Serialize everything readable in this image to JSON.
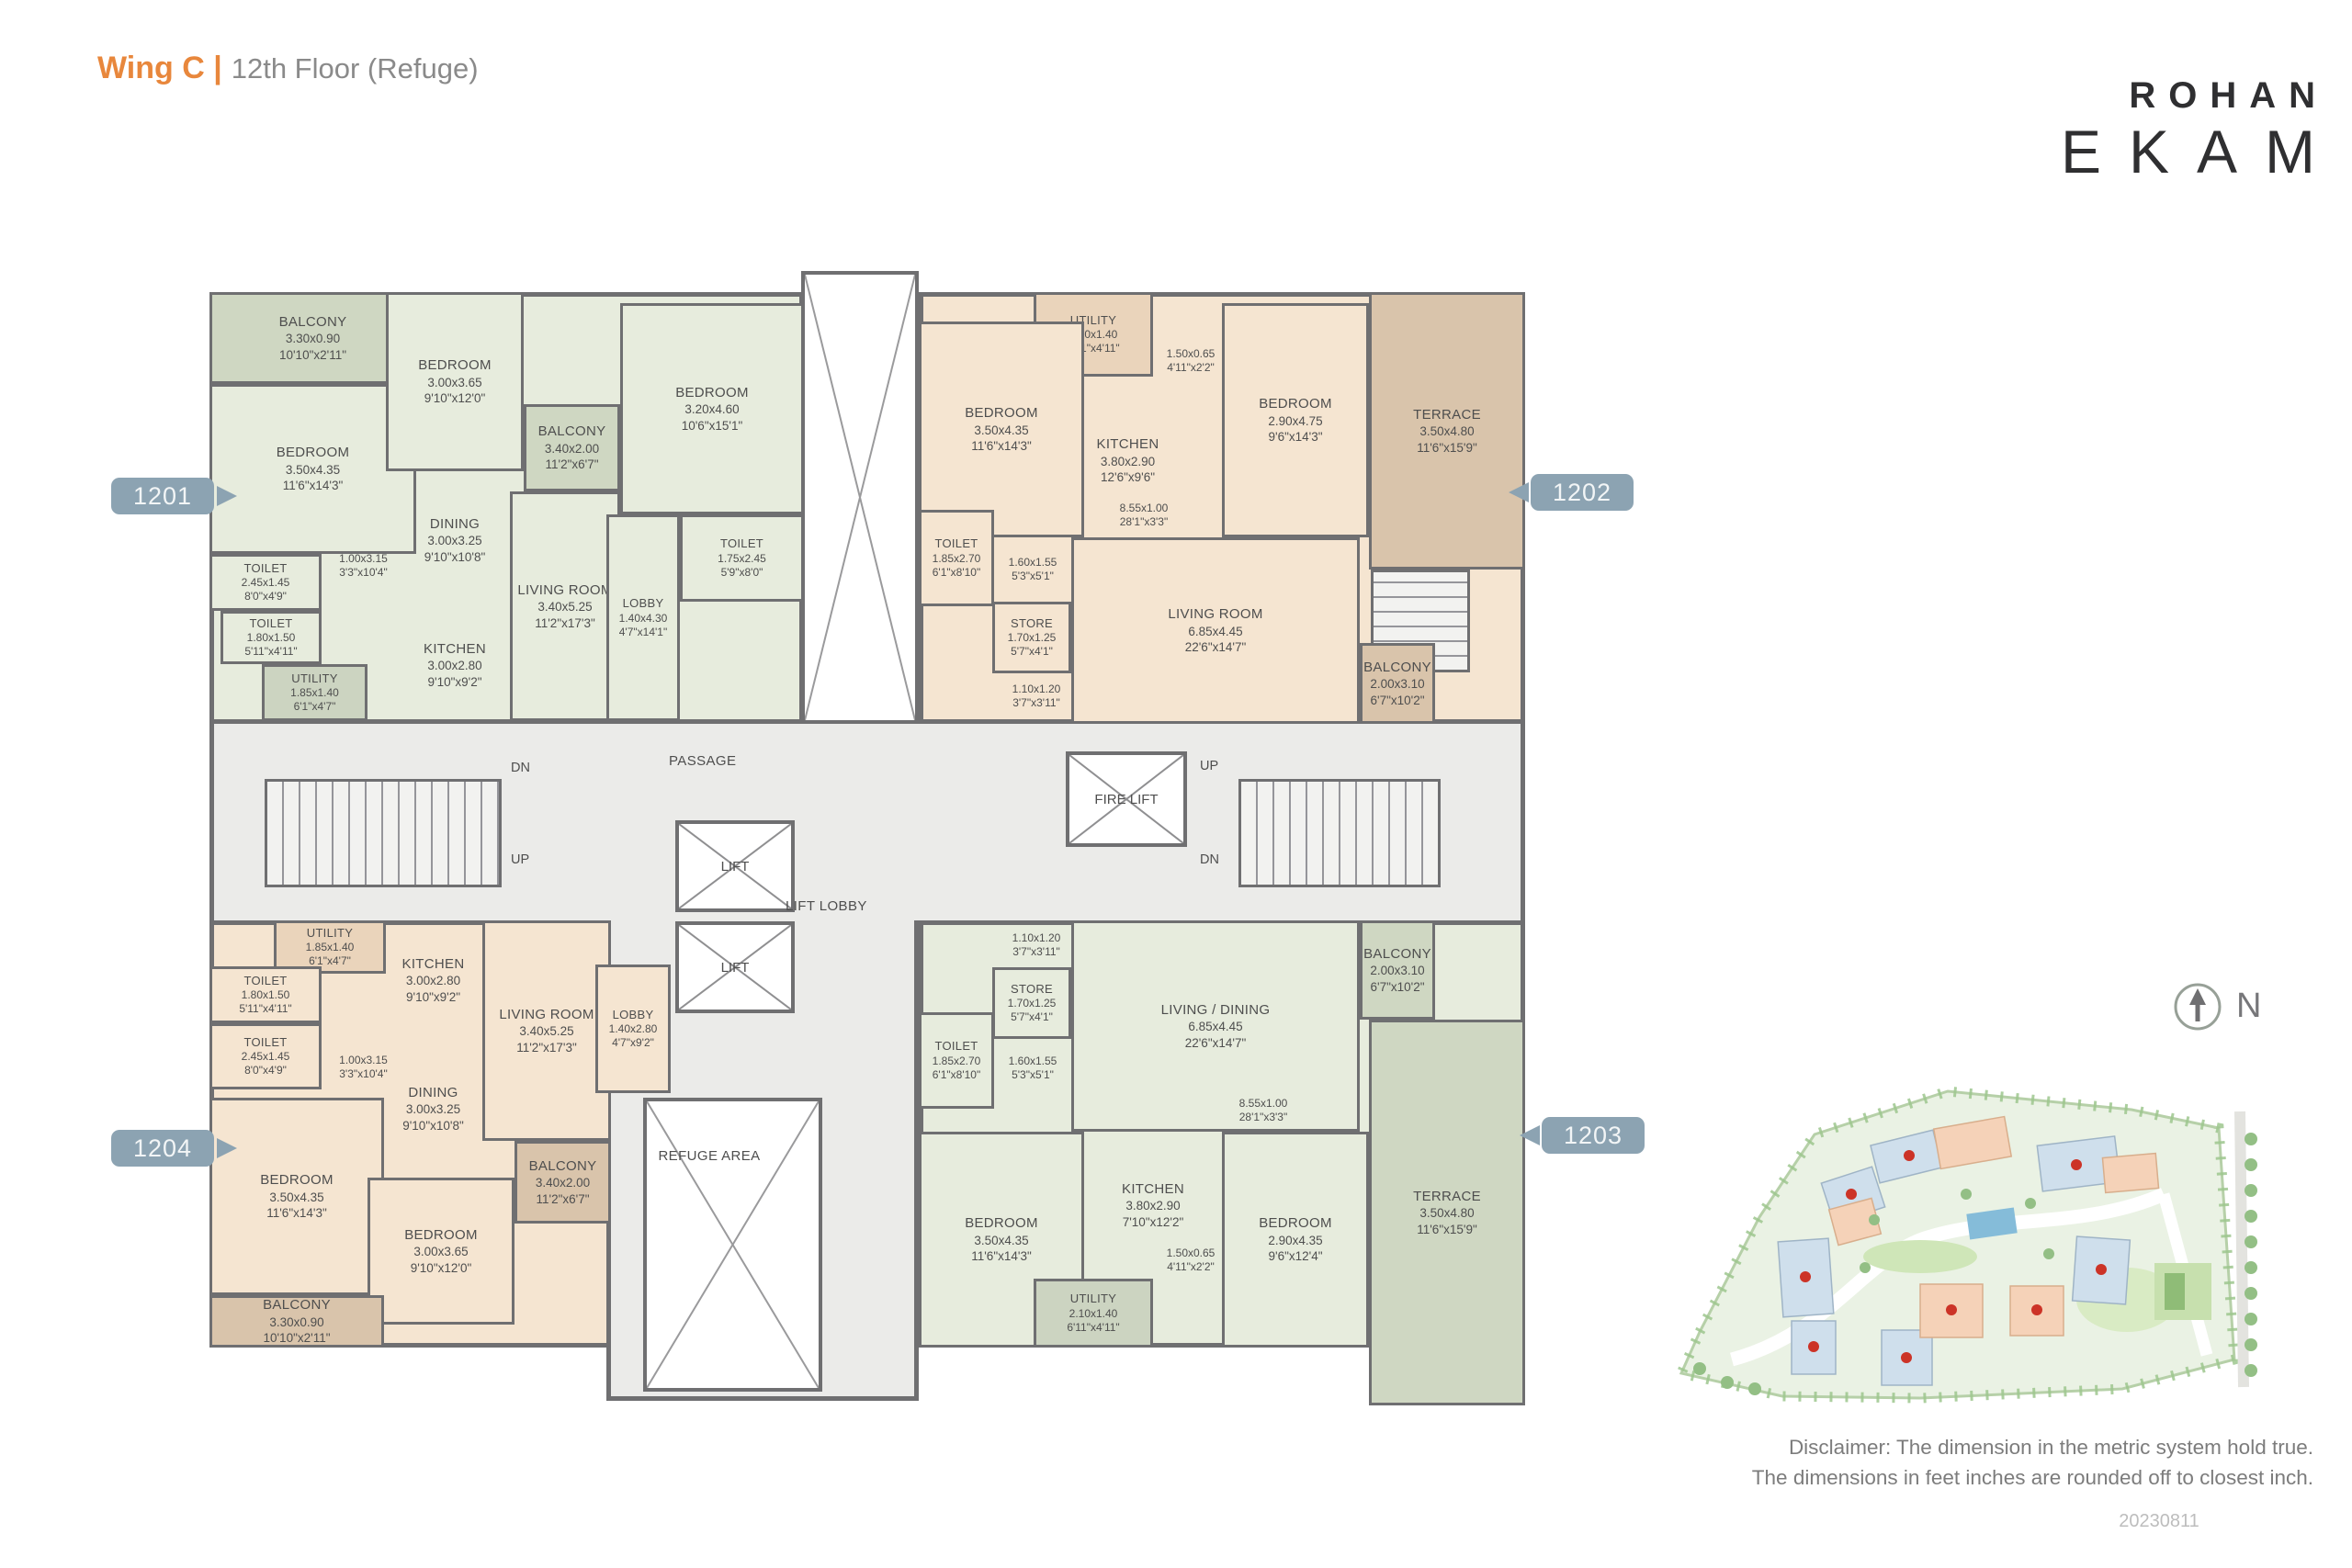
{
  "header": {
    "wing_label": "Wing C |",
    "floor_label": "12th Floor (Refuge)",
    "brand_top": "ROHAN",
    "brand_bottom": "EKAM"
  },
  "units": {
    "u1201": "1201",
    "u1202": "1202",
    "u1203": "1203",
    "u1204": "1204"
  },
  "rooms": {
    "u1201_balcony_top": {
      "name": "BALCONY",
      "metric": "3.30x0.90",
      "imperial": "10'10\"x2'11\""
    },
    "u1201_bedroom_left": {
      "name": "BEDROOM",
      "metric": "3.50x4.35",
      "imperial": "11'6\"x14'3\""
    },
    "u1201_toilet_a": {
      "name": "TOILET",
      "metric": "2.45x1.45",
      "imperial": "8'0\"x4'9\""
    },
    "u1201_toilet_b": {
      "name": "TOILET",
      "metric": "1.80x1.50",
      "imperial": "5'11\"x4'11\""
    },
    "u1201_utility": {
      "name": "UTILITY",
      "metric": "1.85x1.40",
      "imperial": "6'1\"x4'7\""
    },
    "u1201_pass": {
      "metric": "1.00x3.15",
      "imperial": "3'3\"x10'4\""
    },
    "u1201_bedroom_mid": {
      "name": "BEDROOM",
      "metric": "3.00x3.65",
      "imperial": "9'10\"x12'0\""
    },
    "u1201_balcony_mid": {
      "name": "BALCONY",
      "metric": "3.40x2.00",
      "imperial": "11'2\"x6'7\""
    },
    "u1201_dining": {
      "name": "DINING",
      "metric": "3.00x3.25",
      "imperial": "9'10\"x10'8\""
    },
    "u1201_kitchen": {
      "name": "KITCHEN",
      "metric": "3.00x2.80",
      "imperial": "9'10\"x9'2\""
    },
    "u1201_living": {
      "name": "LIVING ROOM",
      "metric": "3.40x5.25",
      "imperial": "11'2\"x17'3\""
    },
    "u1201_bedroom_right": {
      "name": "BEDROOM",
      "metric": "3.20x4.60",
      "imperial": "10'6\"x15'1\""
    },
    "u1201_toilet_c": {
      "name": "TOILET",
      "metric": "1.75x2.45",
      "imperial": "5'9\"x8'0\""
    },
    "u1201_lobby": {
      "name": "LOBBY",
      "metric": "1.40x4.30",
      "imperial": "4'7\"x14'1\""
    },
    "u1202_utility": {
      "name": "UTILITY",
      "metric": "2.10x1.40",
      "imperial": "6'11\"x4'11\""
    },
    "u1202_niche_a": {
      "metric": "1.50x0.65",
      "imperial": "4'11\"x2'2\""
    },
    "u1202_bedroom_left": {
      "name": "BEDROOM",
      "metric": "3.50x4.35",
      "imperial": "11'6\"x14'3\""
    },
    "u1202_kitchen": {
      "name": "KITCHEN",
      "metric": "3.80x2.90",
      "imperial": "12'6\"x9'6\""
    },
    "u1202_bedroom_right": {
      "name": "BEDROOM",
      "metric": "2.90x4.75",
      "imperial": "9'6\"x14'3\""
    },
    "u1202_terrace": {
      "name": "TERRACE",
      "metric": "3.50x4.80",
      "imperial": "11'6\"x15'9\""
    },
    "u1202_toilet": {
      "name": "TOILET",
      "metric": "1.85x2.70",
      "imperial": "6'1\"x8'10\""
    },
    "u1202_niche_b": {
      "metric": "1.60x1.55",
      "imperial": "5'3\"x5'1\""
    },
    "u1202_store": {
      "name": "STORE",
      "metric": "1.70x1.25",
      "imperial": "5'7\"x4'1\""
    },
    "u1202_niche_c": {
      "metric": "1.10x1.20",
      "imperial": "3'7\"x3'11\""
    },
    "u1202_pass": {
      "metric": "8.55x1.00",
      "imperial": "28'1\"x3'3\""
    },
    "u1202_living": {
      "name": "LIVING ROOM",
      "metric": "6.85x4.45",
      "imperial": "22'6\"x14'7\""
    },
    "u1202_balcony": {
      "name": "BALCONY",
      "metric": "2.00x3.10",
      "imperial": "6'7\"x10'2\""
    },
    "u1203_niche_c": {
      "metric": "1.10x1.20",
      "imperial": "3'7\"x3'11\""
    },
    "u1203_store": {
      "name": "STORE",
      "metric": "1.70x1.25",
      "imperial": "5'7\"x4'1\""
    },
    "u1203_toilet": {
      "name": "TOILET",
      "metric": "1.85x2.70",
      "imperial": "6'1\"x8'10\""
    },
    "u1203_niche_b": {
      "metric": "1.60x1.55",
      "imperial": "5'3\"x5'1\""
    },
    "u1203_living": {
      "name": "LIVING / DINING",
      "metric": "6.85x4.45",
      "imperial": "22'6\"x14'7\""
    },
    "u1203_balcony": {
      "name": "BALCONY",
      "metric": "2.00x3.10",
      "imperial": "6'7\"x10'2\""
    },
    "u1203_pass": {
      "metric": "8.55x1.00",
      "imperial": "28'1\"x3'3\""
    },
    "u1203_bedroom_left": {
      "name": "BEDROOM",
      "metric": "3.50x4.35",
      "imperial": "11'6\"x14'3\""
    },
    "u1203_kitchen": {
      "name": "KITCHEN",
      "metric": "3.80x2.90",
      "imperial": "7'10\"x12'2\""
    },
    "u1203_niche_a": {
      "metric": "1.50x0.65",
      "imperial": "4'11\"x2'2\""
    },
    "u1203_utility": {
      "name": "UTILITY",
      "metric": "2.10x1.40",
      "imperial": "6'11\"x4'11\""
    },
    "u1203_bedroom_right": {
      "name": "BEDROOM",
      "metric": "2.90x4.35",
      "imperial": "9'6\"x12'4\""
    },
    "u1203_terrace": {
      "name": "TERRACE",
      "metric": "3.50x4.80",
      "imperial": "11'6\"x15'9\""
    },
    "u1204_utility": {
      "name": "UTILITY",
      "metric": "1.85x1.40",
      "imperial": "6'1\"x4'7\""
    },
    "u1204_kitchen": {
      "name": "KITCHEN",
      "metric": "3.00x2.80",
      "imperial": "9'10\"x9'2\""
    },
    "u1204_living": {
      "name": "LIVING ROOM",
      "metric": "3.40x5.25",
      "imperial": "11'2\"x17'3\""
    },
    "u1204_toilet_a": {
      "name": "TOILET",
      "metric": "1.80x1.50",
      "imperial": "5'11\"x4'11\""
    },
    "u1204_toilet_b": {
      "name": "TOILET",
      "metric": "2.45x1.45",
      "imperial": "8'0\"x4'9\""
    },
    "u1204_pass": {
      "metric": "1.00x3.15",
      "imperial": "3'3\"x10'4\""
    },
    "u1204_dining": {
      "name": "DINING",
      "metric": "3.00x3.25",
      "imperial": "9'10\"x10'8\""
    },
    "u1204_bedroom_left": {
      "name": "BEDROOM",
      "metric": "3.50x4.35",
      "imperial": "11'6\"x14'3\""
    },
    "u1204_bedroom_mid": {
      "name": "BEDROOM",
      "metric": "3.00x3.65",
      "imperial": "9'10\"x12'0\""
    },
    "u1204_balcony_bottom": {
      "name": "BALCONY",
      "metric": "3.30x0.90",
      "imperial": "10'10\"x2'11\""
    },
    "u1204_balcony_mid": {
      "name": "BALCONY",
      "metric": "3.40x2.00",
      "imperial": "11'2\"x6'7\""
    },
    "u1204_lobby": {
      "name": "LOBBY",
      "metric": "1.40x2.80",
      "imperial": "4'7\"x9'2\""
    }
  },
  "core": {
    "passage": "PASSAGE",
    "lift": "LIFT",
    "lift_lobby": "LIFT LOBBY",
    "fire_lift": "FIRE LIFT",
    "refuge": "REFUGE AREA",
    "up": "UP",
    "dn": "DN"
  },
  "compass": {
    "north": "N"
  },
  "footer": {
    "disclaimer_line1": "Disclaimer: The dimension in the metric system hold true.",
    "disclaimer_line2": "The dimensions in feet inches are rounded off to closest inch.",
    "date_code": "20230811"
  },
  "colors": {
    "accent_orange": "#E8873C",
    "badge_blue": "#8CA3B2",
    "wall_grey": "#6F6F71",
    "sage_room": "#E7ECDD",
    "peach_room": "#F5E5D1",
    "terrace_tan": "#D9C4AB"
  }
}
